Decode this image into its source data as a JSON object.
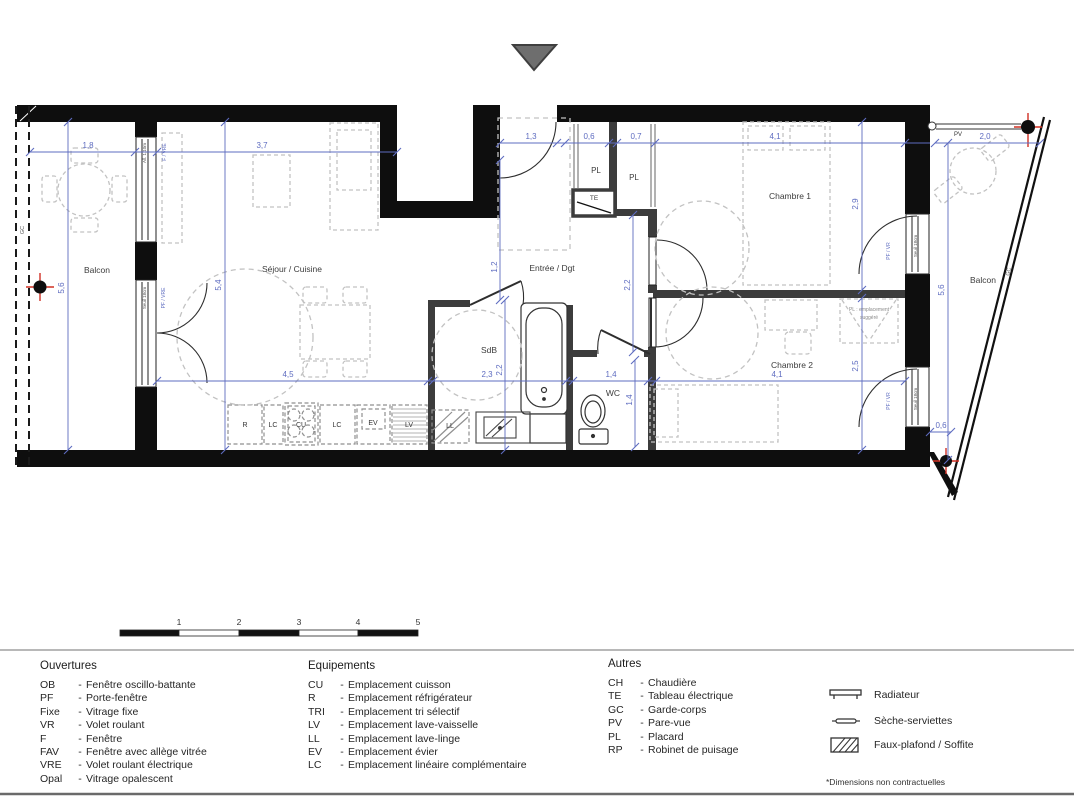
{
  "icons": {
    "entrance_marker": "triangle-down",
    "water_tap": "crosshair-circle",
    "radiator": "radiator-bar",
    "towel_dryer": "towel-bar",
    "false_ceiling": "hatched-box"
  },
  "plan": {
    "rooms": {
      "balcon_left": "Balcon",
      "sejour": "Séjour / Cuisine",
      "entree": "Entrée / Dgt",
      "sdb": "SdB",
      "wc": "WC",
      "chambre1": "Chambre 1",
      "chambre2": "Chambre 2",
      "balcon_right": "Balcon"
    },
    "closets": {
      "pl1": "PL",
      "pl2": "PL",
      "te": "TE",
      "pl_suggested_line1": "PL : emplacement",
      "pl_suggested_line2": "suggéré"
    },
    "kitchen_codes": {
      "r": "R",
      "lc1": "LC",
      "cu": "CU",
      "lc2": "LC",
      "ev": "EV",
      "lv": "LV",
      "ll": "LL"
    },
    "dims": {
      "balcon_left_w": "1,8",
      "sejour_w": "3,7",
      "entree_w": "1,3",
      "pl1_w": "0,6",
      "pl2_w": "0,7",
      "chambre1_w": "4,1",
      "balcon_right_w": "2,0",
      "balcon_left_h": "5,6",
      "sejour_h": "5,4",
      "entree_h": "1,2",
      "couloir_h": "2,2",
      "chambre1_h": "2,9",
      "chambre2_h": "2,5",
      "balcon_right_h": "5,6",
      "cuisine_w": "4,5",
      "sdb_w": "2,3",
      "sdb_h": "2,2",
      "wc_w": "1,4",
      "wc_h": "1,4",
      "chambre2_w": "4,1",
      "balcon_right_b": "0,6"
    },
    "annotations": {
      "f_vre": "F / VRE",
      "allege": "All. 1,10m",
      "pf_vre": "PF / VRE",
      "seuil_left": "Seuil 18cm",
      "seuil_ch1": "Seuil 18cm",
      "seuil_ch2": "Seuil 18cm",
      "pf_vr_ch1": "PF / VR",
      "pf_vr_ch2": "PF / VR",
      "pv": "PV",
      "gc_left": "GC",
      "gc_right": "GC"
    }
  },
  "scalebar": {
    "labels": [
      "1",
      "2",
      "3",
      "4",
      "5"
    ]
  },
  "legend": {
    "sep": "-",
    "ouvertures": {
      "title": "Ouvertures",
      "items": [
        {
          "code": "OB",
          "label": "Fenêtre oscillo-battante"
        },
        {
          "code": "PF",
          "label": "Porte-fenêtre"
        },
        {
          "code": "Fixe",
          "label": "Vitrage fixe"
        },
        {
          "code": "VR",
          "label": "Volet roulant"
        },
        {
          "code": "F",
          "label": "Fenêtre"
        },
        {
          "code": "FAV",
          "label": "Fenêtre avec allège vitrée"
        },
        {
          "code": "VRE",
          "label": "Volet roulant électrique"
        },
        {
          "code": "Opal",
          "label": "Vitrage opalescent"
        }
      ]
    },
    "equipements": {
      "title": "Equipements",
      "items": [
        {
          "code": "CU",
          "label": "Emplacement cuisson"
        },
        {
          "code": "R",
          "label": "Emplacement réfrigérateur"
        },
        {
          "code": "TRI",
          "label": "Emplacement tri sélectif"
        },
        {
          "code": "LV",
          "label": "Emplacement lave-vaisselle"
        },
        {
          "code": "LL",
          "label": "Emplacement lave-linge"
        },
        {
          "code": "EV",
          "label": "Emplacement évier"
        },
        {
          "code": "LC",
          "label": "Emplacement linéaire complémentaire"
        }
      ]
    },
    "autres": {
      "title": "Autres",
      "items": [
        {
          "code": "CH",
          "label": "Chaudière"
        },
        {
          "code": "TE",
          "label": "Tableau électrique"
        },
        {
          "code": "GC",
          "label": "Garde-corps"
        },
        {
          "code": "PV",
          "label": "Pare-vue"
        },
        {
          "code": "PL",
          "label": "Placard"
        },
        {
          "code": "RP",
          "label": "Robinet de puisage"
        }
      ]
    },
    "symbols": [
      {
        "name": "radiateur",
        "label": "Radiateur"
      },
      {
        "name": "seche-serviettes",
        "label": "Sèche-serviettes"
      },
      {
        "name": "faux-plafond",
        "label": "Faux-plafond / Soffite"
      }
    ],
    "footnote": "*Dimensions non contractuelles"
  },
  "colors": {
    "wall": "#0e0e0e",
    "partition": "#3c3c3c",
    "dim_blue": "#5e6cc0",
    "furniture_dash": "#c2c2c2",
    "kitchen_dash": "#8f8f8f",
    "marker_red": "#d03024",
    "triangle_gray": "#6e6e6e"
  }
}
